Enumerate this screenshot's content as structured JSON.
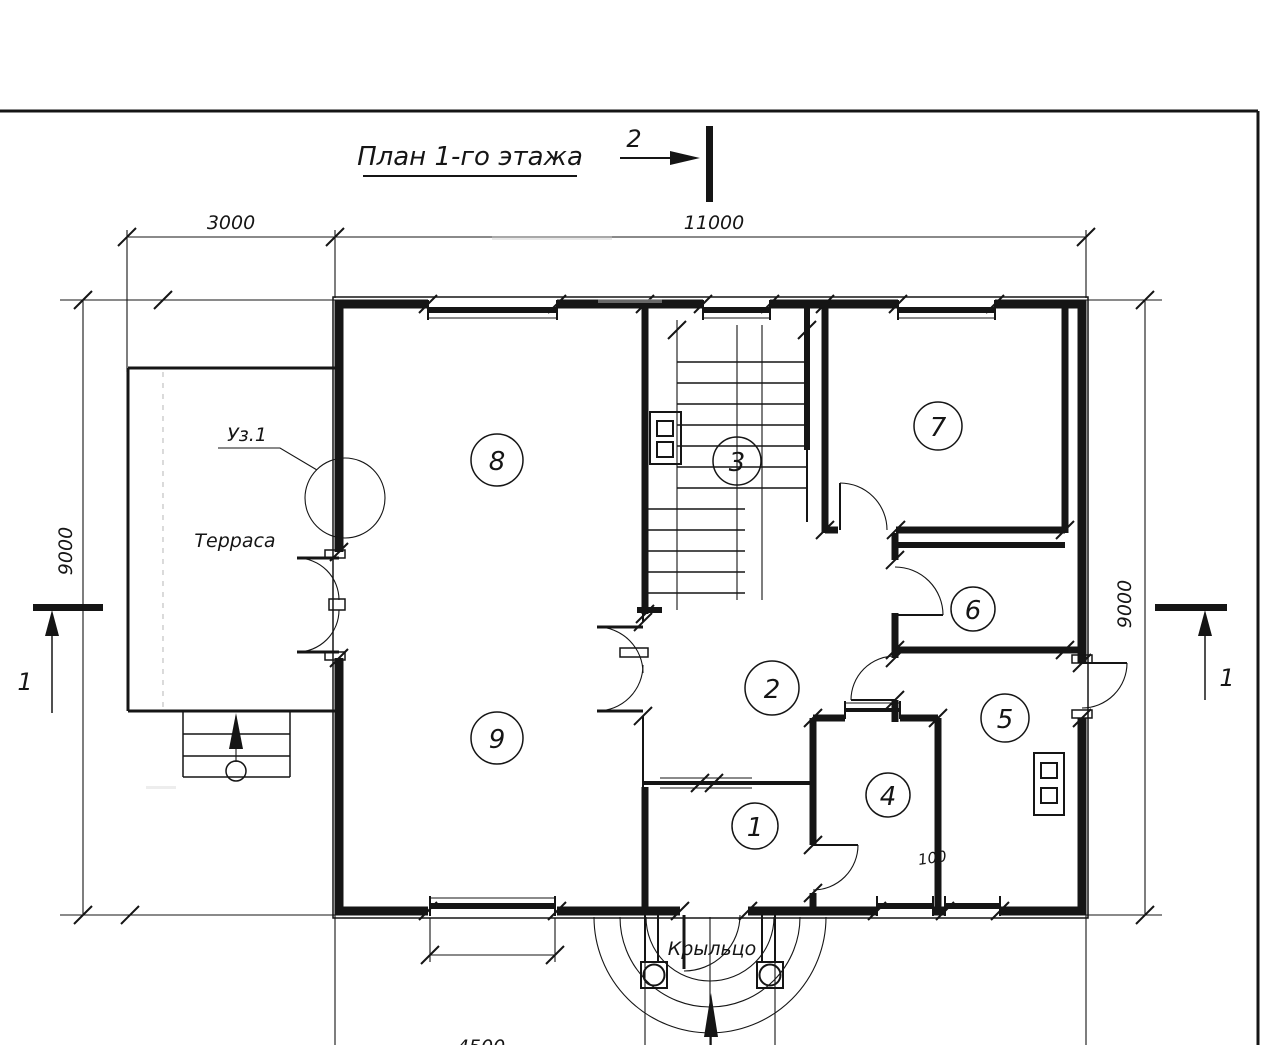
{
  "title": "План 1-го этажа",
  "section_marks": {
    "top": "2",
    "left": "1",
    "right": "1"
  },
  "dims": {
    "terrace_width": "3000",
    "building_width": "11000",
    "left_height": "9000",
    "right_height": "9000",
    "bottom_window": "4500",
    "opening": "100"
  },
  "labels": {
    "terrace": "Терраса",
    "porch": "Крыльцо",
    "detail": "Уз.1"
  },
  "rooms": {
    "r1": "1",
    "r2": "2",
    "r3": "3",
    "r4": "4",
    "r5": "5",
    "r6": "6",
    "r7": "7",
    "r8": "8",
    "r9": "9"
  },
  "colors": {
    "line": "#151515",
    "paper": "#ffffff"
  }
}
